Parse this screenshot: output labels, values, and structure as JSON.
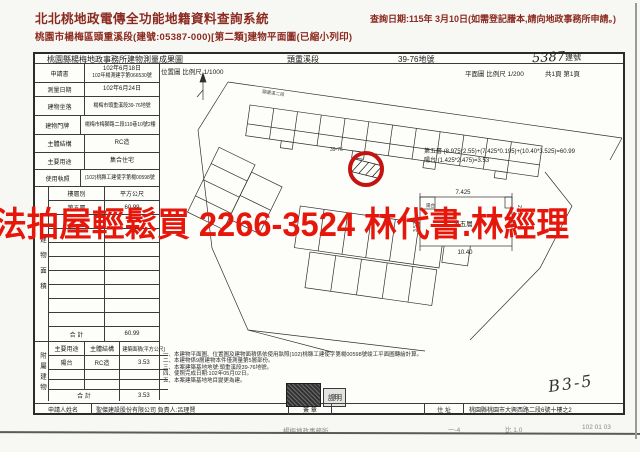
{
  "page": {
    "system_title": "北北桃地政電傳全功能地籍資料查詢系統",
    "query_date": "查詢日期:115年 3月10日(如需登記謄本,請向地政事務所申請。)",
    "subtitle": "桃園市楊梅區頭重溪段(建號:05387-000)[第二類]建物平面圖(已縮小列印)"
  },
  "watermark": {
    "text": "法拍屋輕鬆買 2266-3524 林代書.林經理",
    "color": "#e6160b"
  },
  "form": {
    "title": "桃園縣楊梅地政事務所建物測量成果圖",
    "section": "頭重溪段",
    "parcel": "39-76地號",
    "building_no": "5387",
    "building_no_unit": "建號",
    "info_rows": [
      {
        "label": "申請書",
        "value1": "102年6月18日",
        "value2": "102年楊測建字第066530號"
      },
      {
        "label": "測量日期",
        "value": "102年6月24日"
      },
      {
        "label": "建物坐落",
        "value": "楊梅市頭重溪段39-76地號"
      },
      {
        "label": "建物門牌",
        "value": "楊梅市梅獅路二段110巷10號2樓"
      },
      {
        "label": "主體結構",
        "value": "RC造"
      },
      {
        "label": "主要用途",
        "value": "集合住宅"
      },
      {
        "label": "使用執照",
        "value": "(102)桃縣工建使字第楊00598號"
      }
    ],
    "area_table": {
      "side_label": "建物面積",
      "col1": "樓層別",
      "col2": "平方公尺",
      "row_floor": "第五層",
      "row_area": "60.99",
      "total_label": "合  計",
      "total_value": "60.99"
    },
    "annex_table": {
      "side_label": "附屬建物",
      "col1": "主要用途",
      "col2": "主體結構",
      "col3": "建築面積(平方公尺)",
      "row_use": "陽台",
      "row_structure": "RC造",
      "row_area": "3.53",
      "total_label": "合  計",
      "total_value": "3.53"
    },
    "applicant": {
      "label": "申請人姓名",
      "value": "聖傑建設股份有限公司 負責人:呂理賢",
      "sign_label": "簽 章",
      "address_label": "住 址",
      "address": "桃園縣桃園市大興西路二段6號十樓之2"
    }
  },
  "map": {
    "location_scale": "位置圖 比例尺 1/1000",
    "plan_scale": "平面圖 比例尺 1/200",
    "page_info": "共1頁 第1頁",
    "road_label": "頭重溪二段",
    "parcel_label": "39-76",
    "formula1": "第五層 (8.975*2.55)+(7.425*0.195)+(10.40*3.525)=60.99",
    "formula2": "陽台 (1.425*2.475)=3.53",
    "plan": {
      "dim_top": "7.425",
      "dim_bottom": "10.40",
      "dim_right": "2.55",
      "dim_left": "3.525",
      "label": "第五層",
      "balcony": "陽台"
    },
    "notes": [
      "一、本建物平面圖、位置圖及建物面積係依使用執照(102)桃縣工建使字第楊00598號竣工平面圖轉繪計算。",
      "二、本建物係9層建物本件僅測量第5層部份。",
      "三、本案建築基地地號:頭重溪段39-76地號。",
      "四、使照完成日期:102年05月02日。",
      "五、本案建築基地地目變更為建。"
    ],
    "stamp_text": "證明",
    "handwritten_mark": "B3-5"
  },
  "footer": {
    "frag1": "楊梅地政事務所",
    "frag2": "一-4",
    "frag3": "比 1.0",
    "frag4": "102 01 03"
  }
}
